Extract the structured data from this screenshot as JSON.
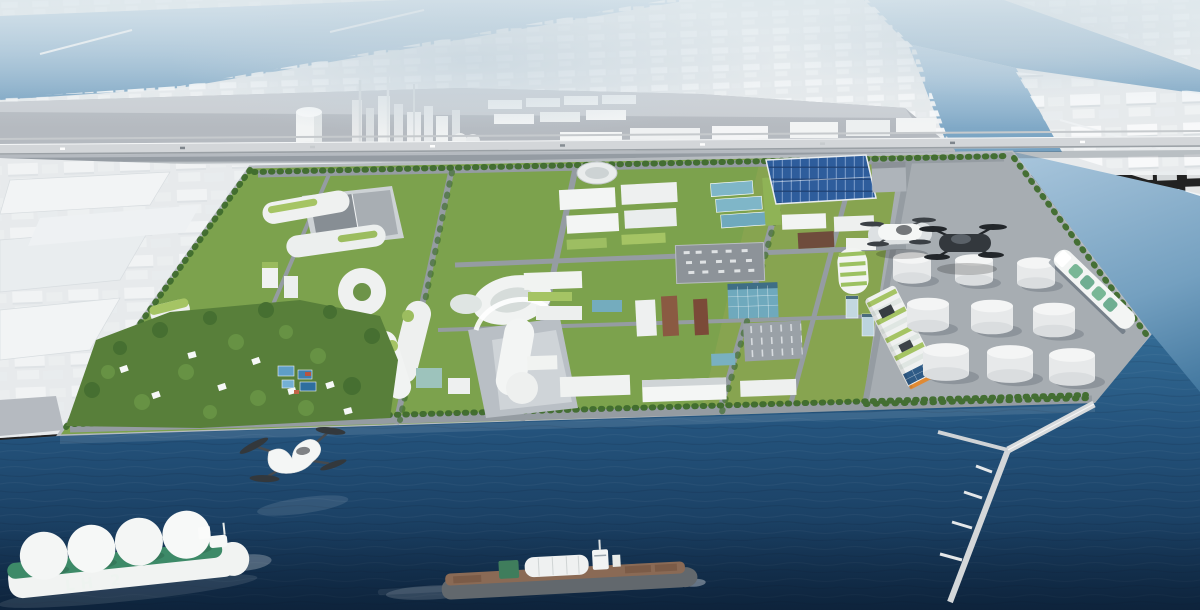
{
  "image": {
    "title": "Aerial 3D rendering of a futuristic hydrogen-powered smart port city on a reclaimed island",
    "type": "architectural-rendering",
    "view": "oblique aerial, looking across an industrial harbor",
    "width_px": 1200,
    "height_px": 610
  },
  "labels": {
    "lh2_ship_marking": "LH 2"
  },
  "counts": {
    "storage_tanks": 9,
    "lh2_sphere_tanks": 4,
    "evtol_aircraft": 3,
    "ships": 3
  },
  "colors": {
    "distant": "#e7eaec",
    "haze": "#dde7ec",
    "channel": "#a9c6dc",
    "channel-deep": "#74a0c0",
    "wharf": "#b5bac0",
    "highway": "#d3d6d9",
    "island-green": "#7ca24d",
    "lawn-green": "#a0bf63",
    "forest": "#587f3a",
    "tree": "#3f6c2d",
    "road": "#959ca2",
    "bldg-white": "#f1f3f2",
    "glass-teal": "#7fb6c8",
    "solar": "#2e5d9c",
    "roof-green": "#a5c464",
    "apron": "#a7adb2",
    "tank": "#ededee",
    "sea-top": "#336b95",
    "sea-mid": "#24537c",
    "sea-deep": "#122f4e",
    "hull-green": "#3d8a68",
    "deck-brown": "#8a6a55",
    "orange": "#e08a34",
    "evtol-dark": "#33383d",
    "pier": "#d8dbdd"
  },
  "scene": {
    "background": [
      {
        "name": "distant-city",
        "desc": "white massing-model city blocks fading into haze"
      },
      {
        "name": "water-channels",
        "desc": "pale blue harbor channels cutting diagonally between land"
      },
      {
        "name": "industrial-plant",
        "desc": "refinery towers, stacks and warehouses on a grey wharf"
      },
      {
        "name": "elevated-highway",
        "desc": "elevated expressway with small vehicles crossing full width"
      }
    ],
    "island": [
      {
        "name": "rnd-campus",
        "desc": "curved white buildings with green roofs"
      },
      {
        "name": "forest-park",
        "desc": "dense trees with small white pavilions and blue pools"
      },
      {
        "name": "landmark-building",
        "desc": "white sculptural spiral building on grey plaza"
      },
      {
        "name": "logistics-zone",
        "desc": "white warehouses, teal glass offices, rooftop plant, parking"
      },
      {
        "name": "solar-roof-building",
        "desc": "large hall roofed with dark blue photovoltaic panels"
      },
      {
        "name": "terraced-green-building",
        "desc": "striped green terraced building with orange accent"
      },
      {
        "name": "tank-farm",
        "desc": "nine white cylindrical hydrogen storage tanks on grey apron"
      },
      {
        "name": "helipad",
        "desc": "vertiport pad with white and dark eVTOL aircraft"
      }
    ],
    "water": [
      {
        "name": "sea",
        "desc": "deep blue sea in the foreground"
      },
      {
        "name": "lh2-carrier-ship",
        "desc": "liquid hydrogen carrier with four spherical tanks, marked LH 2"
      },
      {
        "name": "cargo-ship",
        "desc": "brown-decked tanker sailing bottom centre"
      },
      {
        "name": "docked-tanker",
        "desc": "white and green carrier moored at the east quay"
      },
      {
        "name": "evtol-over-water",
        "desc": "white quad-rotor air taxi flying above the sea"
      },
      {
        "name": "y-shaped-pier",
        "desc": "long trestle pier with T-shaped struts, bottom right"
      }
    ]
  }
}
